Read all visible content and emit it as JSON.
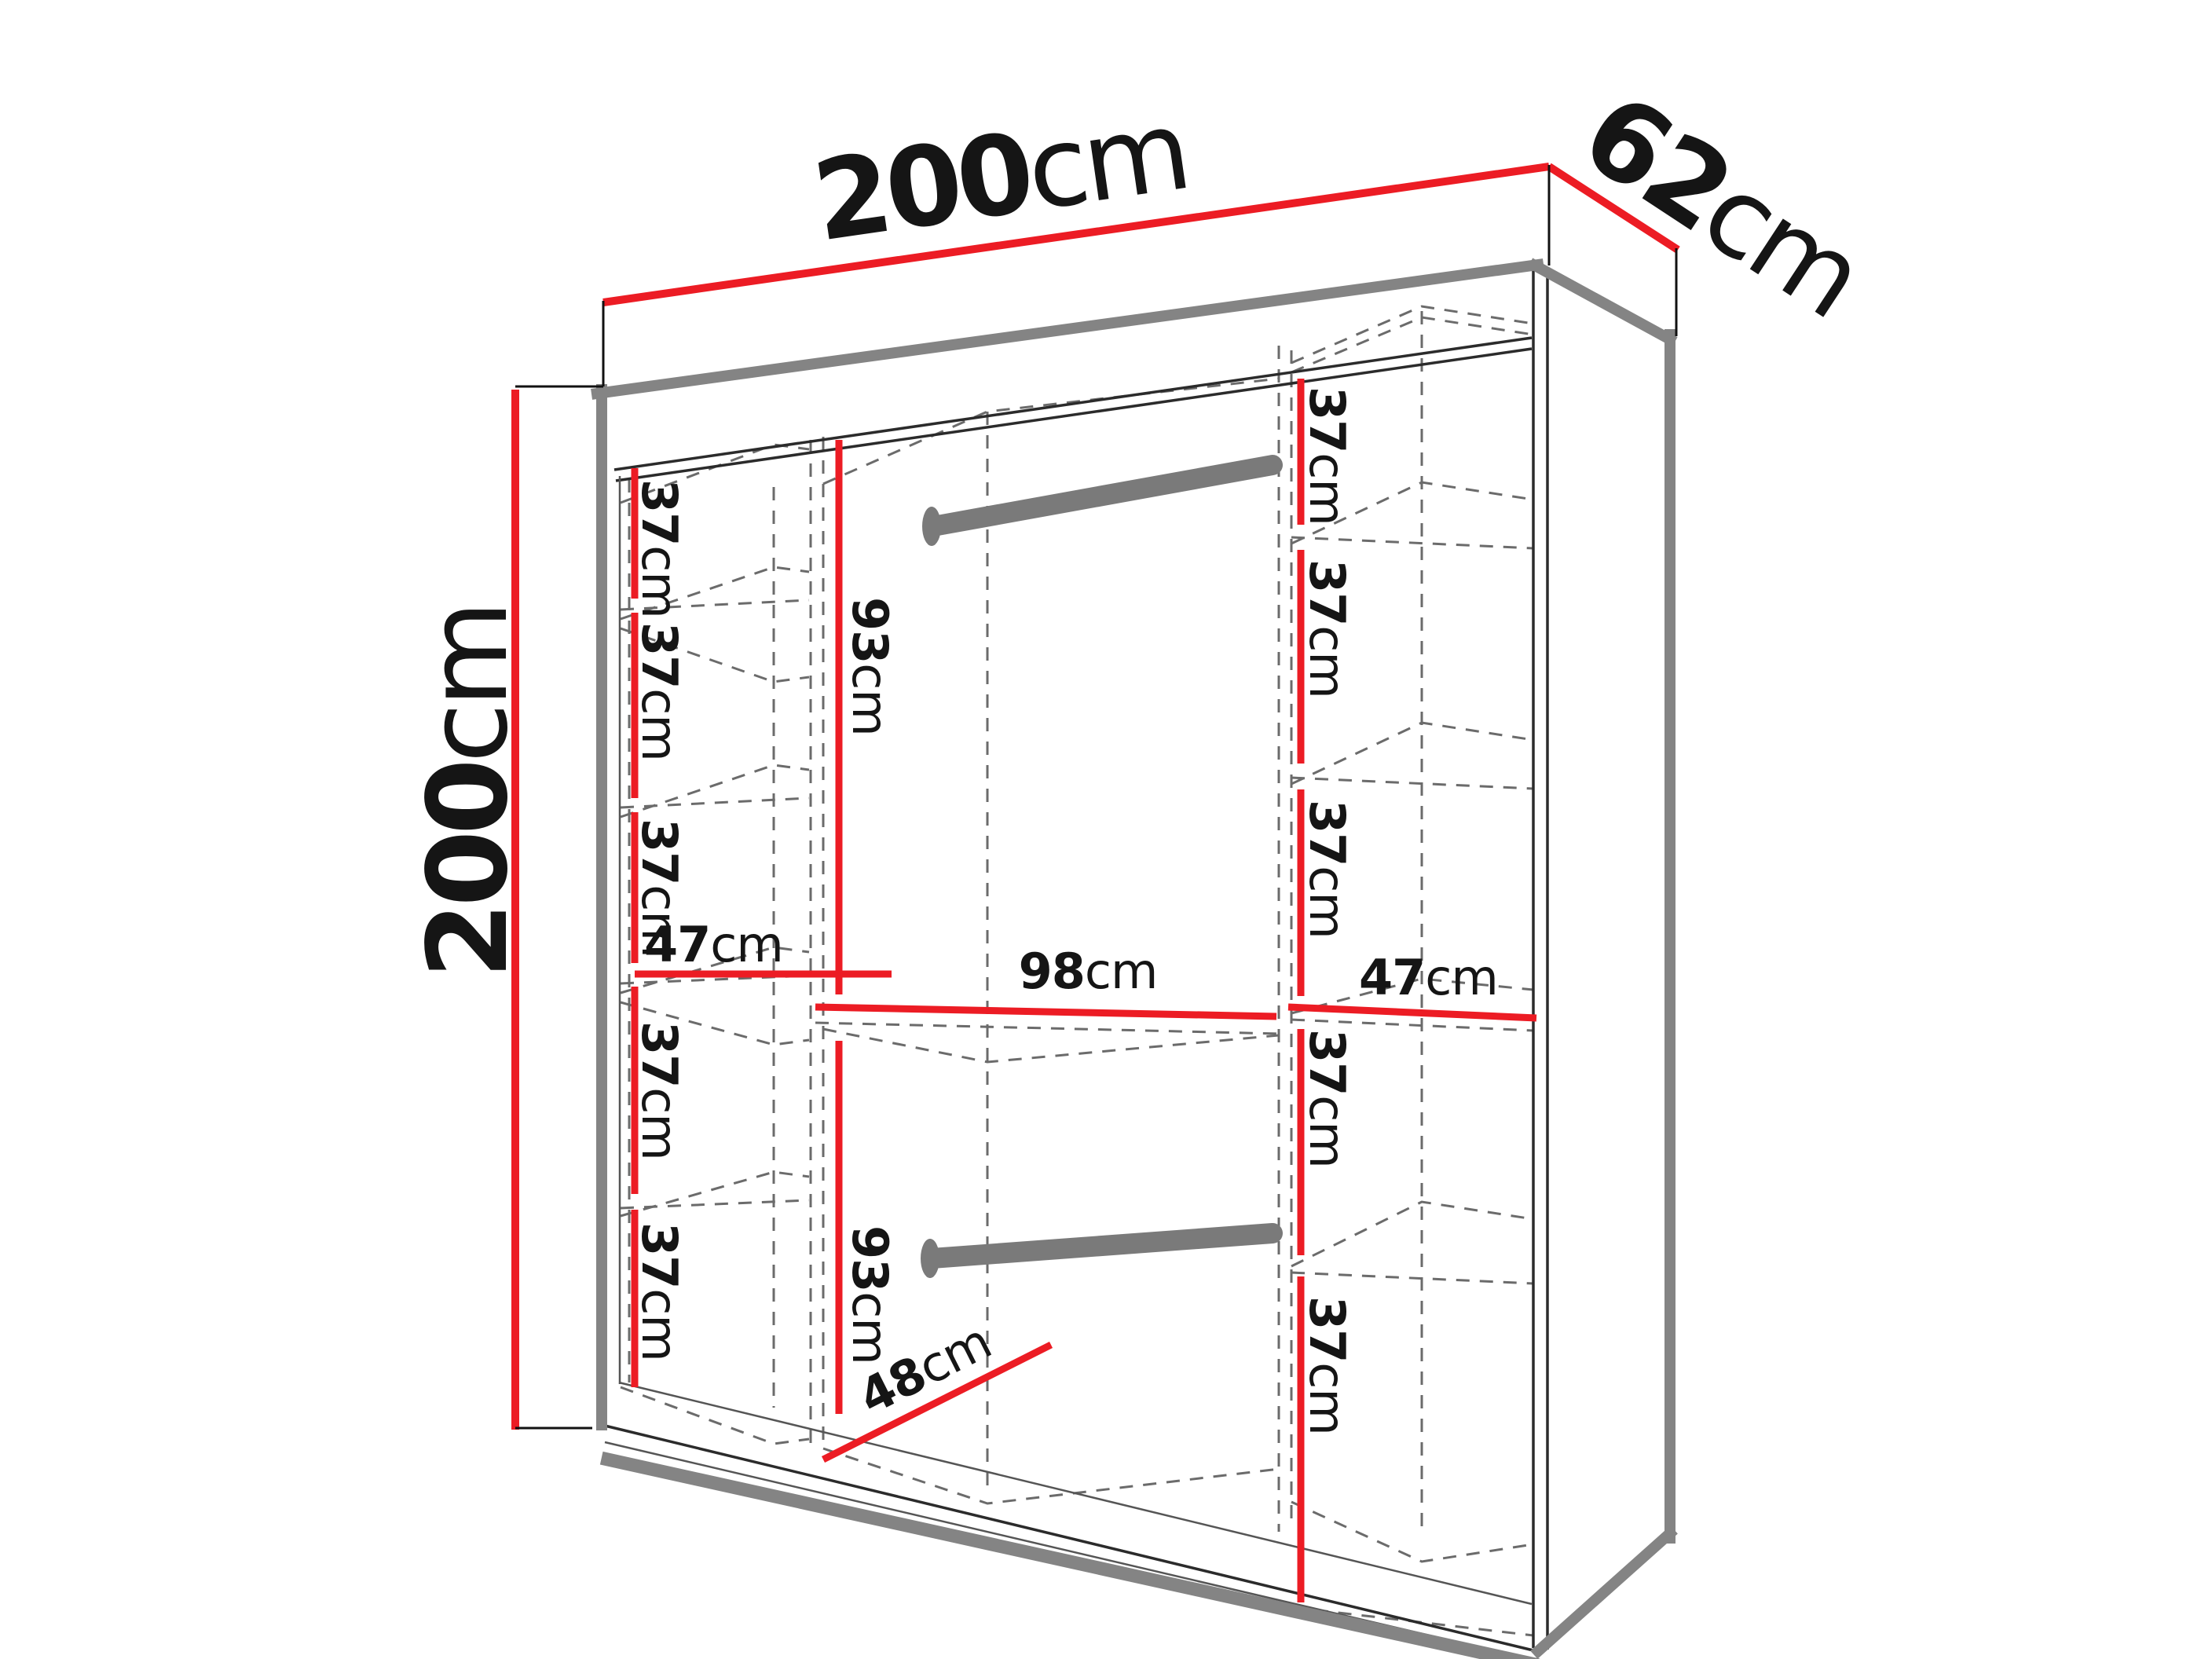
{
  "diagram_type": "wardrobe-interior-dimensions",
  "unit": "cm",
  "colors": {
    "dimension_red": "#ec1c24",
    "frame_gray": "#848484",
    "rod_gray": "#7a7a7a",
    "hidden_line_gray": "#6b6b6b",
    "text_black": "#151515"
  },
  "labels": {
    "overall_width": {
      "num": "200",
      "unit": "cm"
    },
    "overall_depth": {
      "num": "62",
      "unit": "cm"
    },
    "overall_height": {
      "num": "200",
      "unit": "cm"
    },
    "left_shelf_1": {
      "num": "37",
      "unit": "cm"
    },
    "left_shelf_2": {
      "num": "37",
      "unit": "cm"
    },
    "left_shelf_3": {
      "num": "37",
      "unit": "cm"
    },
    "left_col_width": {
      "num": "47",
      "unit": "cm"
    },
    "left_shelf_4": {
      "num": "37",
      "unit": "cm"
    },
    "left_shelf_5": {
      "num": "37",
      "unit": "cm"
    },
    "mid_upper_height": {
      "num": "93",
      "unit": "cm"
    },
    "mid_width": {
      "num": "98",
      "unit": "cm"
    },
    "mid_lower_height": {
      "num": "93",
      "unit": "cm"
    },
    "mid_depth": {
      "num": "48",
      "unit": "cm"
    },
    "right_shelf_1": {
      "num": "37",
      "unit": "cm"
    },
    "right_shelf_2": {
      "num": "37",
      "unit": "cm"
    },
    "right_shelf_3": {
      "num": "37",
      "unit": "cm"
    },
    "right_col_width": {
      "num": "47",
      "unit": "cm"
    },
    "right_shelf_4": {
      "num": "37",
      "unit": "cm"
    },
    "right_shelf_5": {
      "num": "37",
      "unit": "cm"
    }
  }
}
